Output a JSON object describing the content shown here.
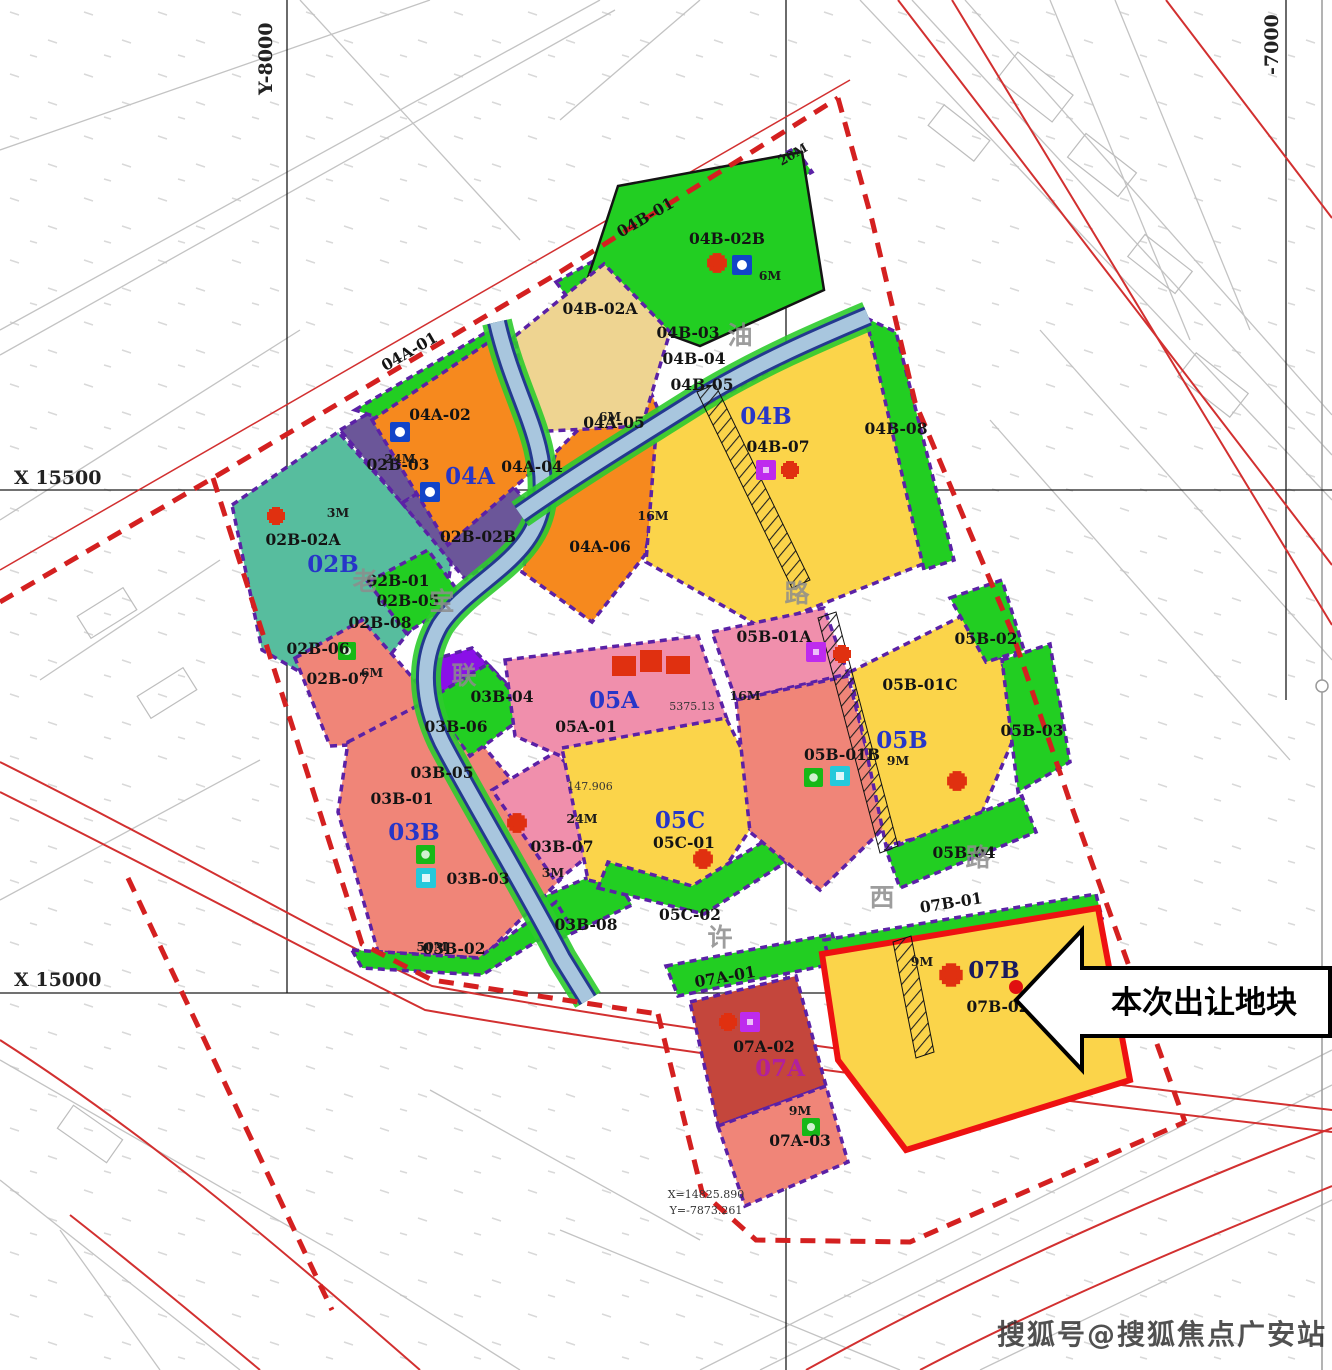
{
  "labels": {
    "zones": {
      "z02B": "02B",
      "z03B": "03B",
      "z04A": "04A",
      "z04B": "04B",
      "z05A": "05A",
      "z05B": "05B",
      "z05C": "05C",
      "z07A": "07A",
      "z07B": "07B"
    },
    "parcels": {
      "p02B_01": "02B-01",
      "p02B_02A": "02B-02A",
      "p02B_02B": "02B-02B",
      "p02B_03": "02B-03",
      "p02B_05": "02B-05",
      "p02B_06": "02B-06",
      "p02B_07": "02B-07",
      "p02B_08": "02B-08",
      "p03B_01": "03B-01",
      "p03B_02": "03B-02",
      "p03B_03": "03B-03",
      "p03B_04": "03B-04",
      "p03B_05": "03B-05",
      "p03B_06": "03B-06",
      "p03B_07": "03B-07",
      "p03B_08": "03B-08",
      "p04A_01": "04A-01",
      "p04A_02": "04A-02",
      "p04A_04": "04A-04",
      "p04A_05": "04A-05",
      "p04A_06": "04A-06",
      "p04B_01": "04B-01",
      "p04B_02A": "04B-02A",
      "p04B_02B": "04B-02B",
      "p04B_03": "04B-03",
      "p04B_04": "04B-04",
      "p04B_05": "04B-05",
      "p04B_07": "04B-07",
      "p04B_08": "04B-08",
      "p05A_01": "05A-01",
      "p05B_01A": "05B-01A",
      "p05B_01B": "05B-01B",
      "p05B_01C": "05B-01C",
      "p05B_02": "05B-02",
      "p05B_03": "05B-03",
      "p05B_04": "05B-04",
      "p05C_01": "05C-01",
      "p05C_02": "05C-02",
      "p07A_01": "07A-01",
      "p07A_02": "07A-02",
      "p07A_03": "07A-03",
      "p07B_01": "07B-01",
      "p07B_02": "07B-02"
    }
  },
  "grid": {
    "gx1": "X 15500",
    "gx2": "X 15000",
    "gy1": "Y-8000",
    "gy2": "-7000"
  },
  "road_chars": {
    "c1": "宝",
    "c2": "联",
    "c3": "许",
    "c4": "西",
    "c5": "路",
    "c6": "路",
    "c7": "油",
    "c8": "老"
  },
  "dims": {
    "d1": "20M",
    "d2": "6M",
    "d3": "24M",
    "d4": "3M",
    "d5": "16M",
    "d6": "6M",
    "d7": "16M",
    "d8": "6M",
    "d9": "24M",
    "d10": "3M",
    "d11": "50M",
    "d12": "9M",
    "d13": "9M",
    "d14": "9M"
  },
  "annotations": {
    "a1": "147.906",
    "a2": "X=14825.890",
    "a3": "Y=-7873.261",
    "a4": "5375.13"
  },
  "callout": {
    "text": "本次出让地块"
  },
  "watermark": {
    "text": "搜狐号@搜狐焦点广安站"
  },
  "colors": {
    "orange": "#F6891E",
    "yellow": "#FBD44A",
    "tan": "#EED491",
    "green": "#22CE22",
    "teal": "#57BD9E",
    "purple_parcel": "#6B5699",
    "pink": "#F08FAC",
    "salmon": "#F08578",
    "dark_red": "#C4463C",
    "violet_blob": "#8A10E8",
    "river_fill": "#A8C6DE",
    "river_edge": "#24398F",
    "boundary_red_dashed": "#D42020",
    "parcel_dash": "#5B21A6",
    "road_red": "#D23030",
    "outline_07B": "#EE1111",
    "zone_label_blue": "#2736C8"
  }
}
